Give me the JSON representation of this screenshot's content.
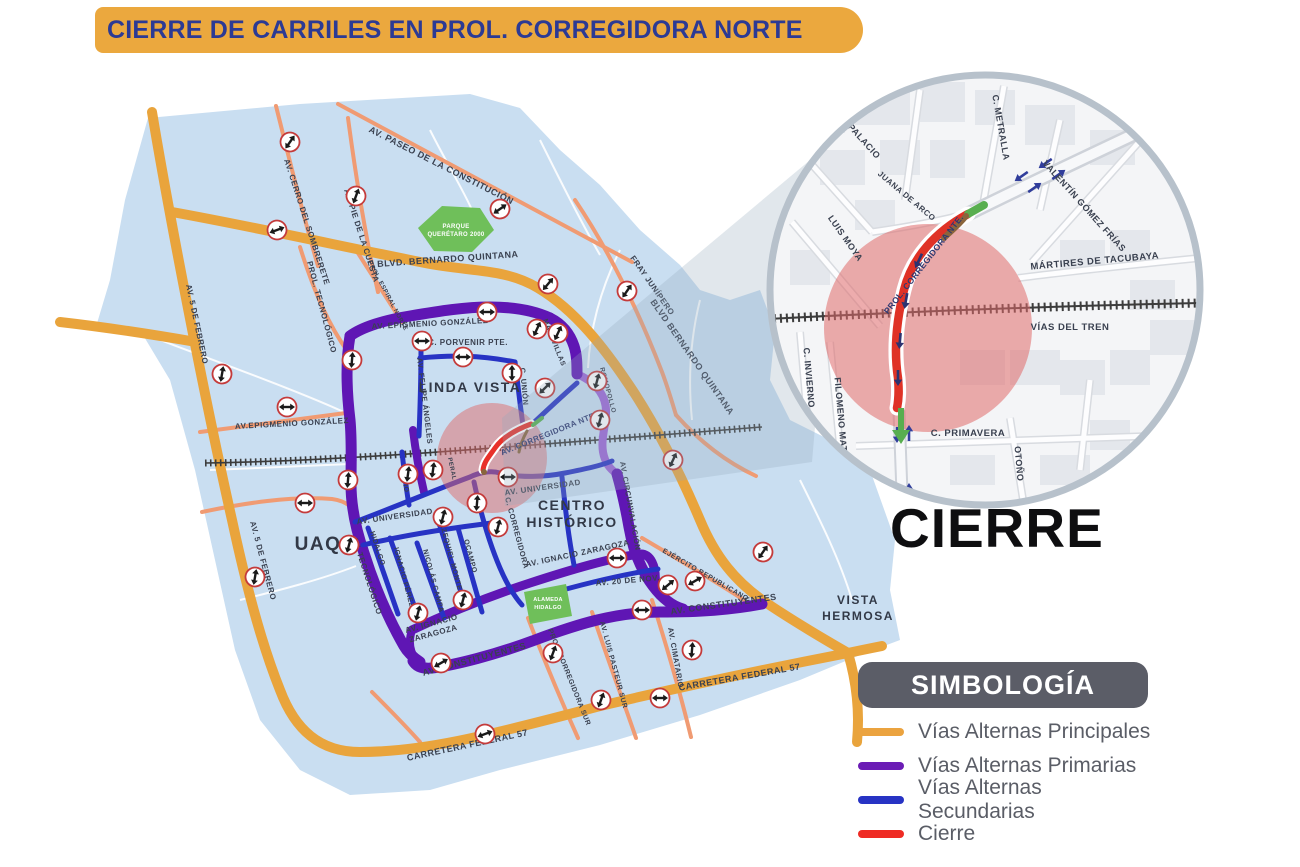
{
  "title": "CIERRE DE CARRILES EN PROL. CORREGIDORA NORTE",
  "cierre_caption": "CIERRE",
  "legend": {
    "title": "SIMBOLOGÍA",
    "items": [
      {
        "label": "Vías Alternas Principales",
        "color": "#EBA33F"
      },
      {
        "label": "Vías Alternas Primarias",
        "color": "#6B1CB5"
      },
      {
        "label": "Vías Alternas Secundarias",
        "color": "#2733C4"
      },
      {
        "label": "Cierre",
        "color": "#EF2B24"
      }
    ]
  },
  "map": {
    "districts": {
      "linda_vista": "LINDA VISTA",
      "centro_l1": "CENTRO",
      "centro_l2": "HISTÓRICO",
      "uaq": "UAQ",
      "vista_l1": "VISTA",
      "vista_l2": "HERMOSA"
    },
    "parks": {
      "parque_l1": "PARQUE",
      "parque_l2": "QUERÉTARO 2000",
      "alameda_l1": "ALAMEDA",
      "alameda_l2": "HIDALGO"
    },
    "labels": {
      "cerro_sombrerete": "AV. CERRO DEL SOMBRERETE",
      "pie_cuesta": "AV. PIE DE LA CUESTA",
      "paseo_constitucion": "AV. PASEO DE LA CONSTITUCIÓN",
      "bernardo_quintana_w": "BLVD. BERNARDO QUINTANA",
      "bernardo_quintana_e": "BLVD BERNARDO QUINTANA",
      "fray_junipero": "FRAY JUNÍPERO",
      "prol_tecnologico": "PROL. TECNOLÓGICO",
      "prol_espiral": "PROL. ESPIRAL NORTE",
      "cinco_febrero_n": "AV. 5 DE FEBRERO",
      "cinco_febrero_s": "AV. 5 DE FEBRERO",
      "epigmenio_n": "AV. EPIGMENIO GONZÁLEZ",
      "epigmenio_w": "AV.EPIGMENIO GONZÁLEZ",
      "porvenir": "C. PORVENIR PTE.",
      "felipe_angeles": "AV. FELIPE ÁNGELES",
      "union": "C. UNIÓN",
      "maravillas": "MARAVILLAS",
      "corregidora_nte": "AV. CORREGIDORA NTE.",
      "romopollo": "ROMOPOLLO",
      "circunvalacion": "AV. CIRCUNVALACIÓN",
      "universidad_w": "AV. UNIVERSIDAD",
      "universidad_e": "AV. UNIVERSIDAD",
      "estio": "ESTIO",
      "hidalgo": "HIDALGO",
      "ignacio_perez": "IGNACIO PÉREZ",
      "nicolas_campa": "NICOLÁS CAMPA",
      "ezequiel_montes": "EZEQUIEL MONTES",
      "ocampo": "OCAMPO",
      "c_corregidora": "C. CORREGIDORA",
      "peral": "PERAL",
      "tecnologico": "AV. TECNOLÓGICO",
      "zaragoza_e": "AV. IGNACIO ZARAGOZA",
      "zaragoza_w_l1": "AV. IGNACIO",
      "zaragoza_w_l2": "ZARAGOZA",
      "veinte_nov": "AV. 20 DE NOV.",
      "ejercito": "EJÉRCITO REPUBLICANO",
      "constituyentes_w": "AV. CONSTITUYENTES",
      "constituyentes_e": "AV. CONSTITUYENTES",
      "corregidora_sur": "PROL. CORREGIDORA SUR",
      "pasteur_sur": "AV. LUIS PASTEUR SUR",
      "cimatario": "AV. CIMATARIO",
      "carretera_w": "CARRETERA FEDERAL 57",
      "carretera_e": "CARRETERA FEDERAL 57"
    }
  },
  "inset": {
    "labels": {
      "rivapalacio": "C. RIVAPALACIO",
      "juana_arco": "JUANA DE ARCO",
      "luis_moya": "LUIS MOYA",
      "metralla": "C. METRALLA",
      "gomez_frias": "VALENTÍN GÓMEZ FRÍAS",
      "martires": "MÁRTIRES DE TACUBAYA",
      "vias_tren": "VÍAS DEL TREN",
      "invierno": "C. INVIERNO",
      "filomeno": "FILOMENO MATA",
      "primavera": "C. PRIMAVERA",
      "otono": "OTOÑO",
      "prol_corregidora": "PROL. CORREGIDORA NTE."
    }
  }
}
